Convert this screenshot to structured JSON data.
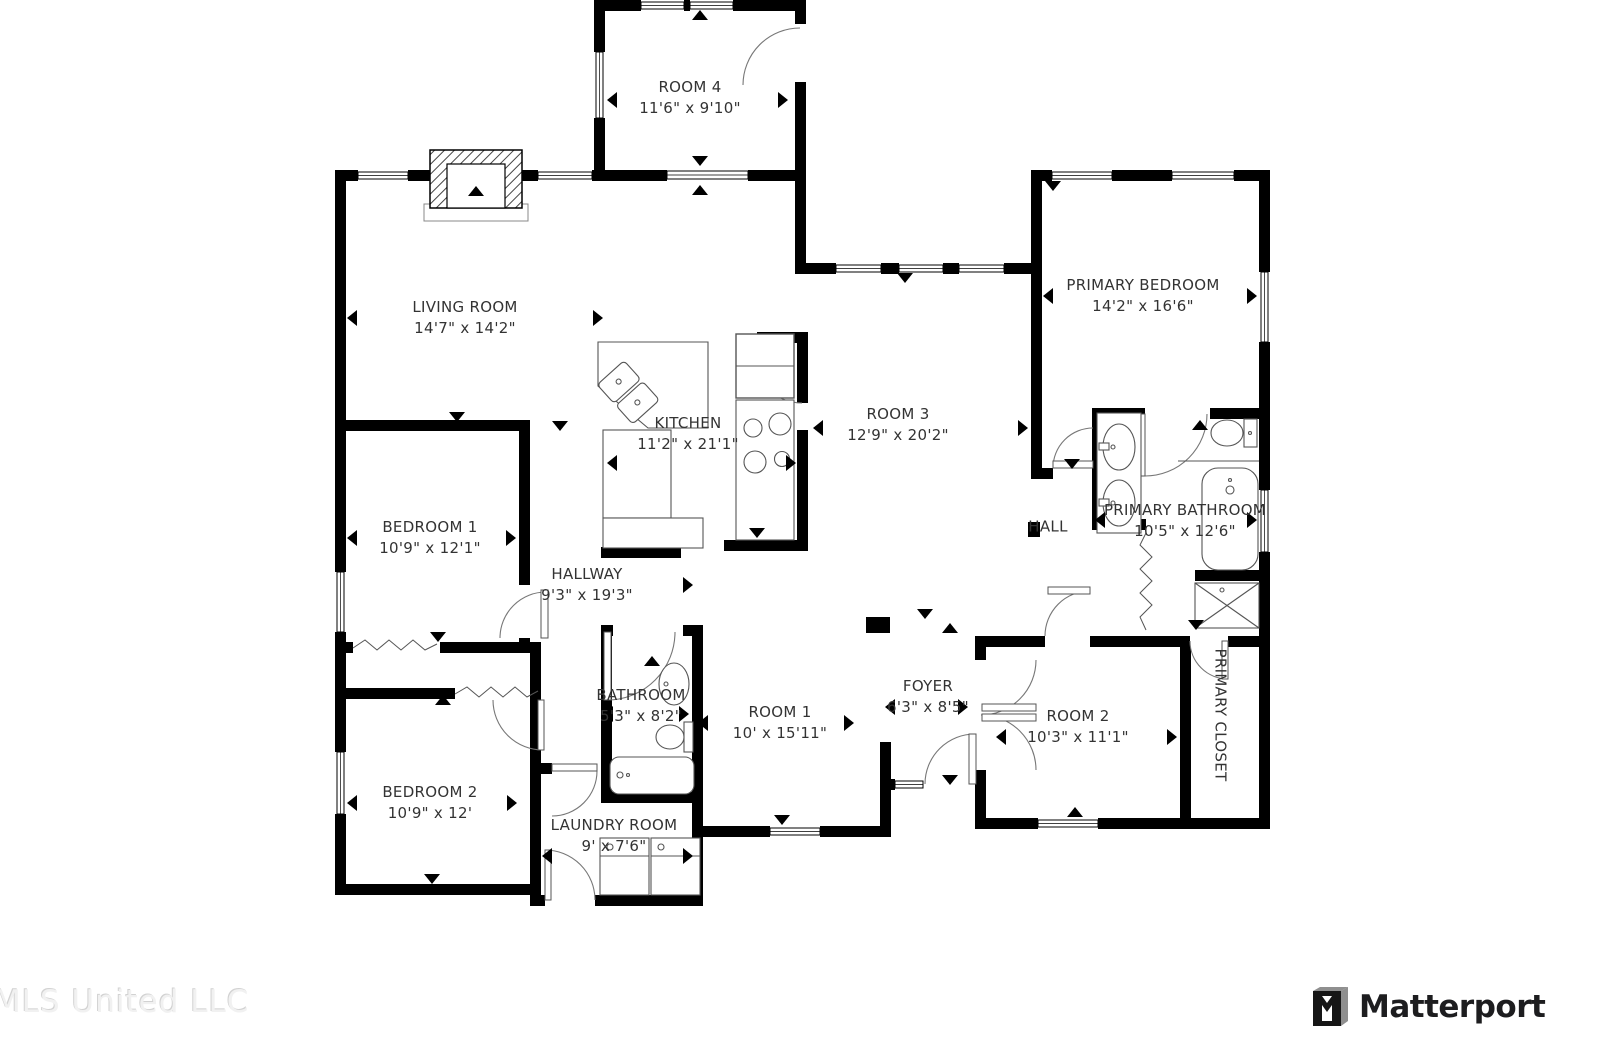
{
  "page": {
    "type": "residential-floor-plan"
  },
  "rooms": [
    {
      "id": "room-4",
      "name": "ROOM 4",
      "dims": "11'6\" x 9'10\""
    },
    {
      "id": "living-room",
      "name": "LIVING ROOM",
      "dims": "14'7\" x 14'2\""
    },
    {
      "id": "primary-bedroom",
      "name": "PRIMARY BEDROOM",
      "dims": "14'2\" x 16'6\""
    },
    {
      "id": "kitchen",
      "name": "KITCHEN",
      "dims": "11'2\" x 21'1\""
    },
    {
      "id": "room-3",
      "name": "ROOM 3",
      "dims": "12'9\" x 20'2\""
    },
    {
      "id": "bedroom-1",
      "name": "BEDROOM 1",
      "dims": "10'9\" x 12'1\""
    },
    {
      "id": "hallway",
      "name": "HALLWAY",
      "dims": "9'3\" x 19'3\""
    },
    {
      "id": "hall",
      "name": "HALL",
      "dims": ""
    },
    {
      "id": "primary-bathroom",
      "name": "PRIMARY BATHROOM",
      "dims": "10'5\" x 12'6\""
    },
    {
      "id": "bathroom",
      "name": "BATHROOM",
      "dims": "5'3\" x 8'2\""
    },
    {
      "id": "room-1",
      "name": "ROOM 1",
      "dims": "10' x 15'11\""
    },
    {
      "id": "foyer",
      "name": "FOYER",
      "dims": "6'3\" x 8'5\""
    },
    {
      "id": "room-2",
      "name": "ROOM 2",
      "dims": "10'3\" x 11'1\""
    },
    {
      "id": "primary-closet",
      "name": "PRIMARY CLOSET",
      "dims": ""
    },
    {
      "id": "bedroom-2",
      "name": "BEDROOM 2",
      "dims": "10'9\" x 12'"
    },
    {
      "id": "laundry-room",
      "name": "LAUNDRY ROOM",
      "dims": "9' x 7'6\""
    }
  ],
  "footer": {
    "watermark": "MLS United LLC",
    "brand": "Matterport"
  },
  "colors": {
    "wall": "#000000",
    "label_text": "#333333",
    "fixture_line": "#555555",
    "watermark": "#f1f1f1",
    "brand_text": "#1d1d1f"
  }
}
